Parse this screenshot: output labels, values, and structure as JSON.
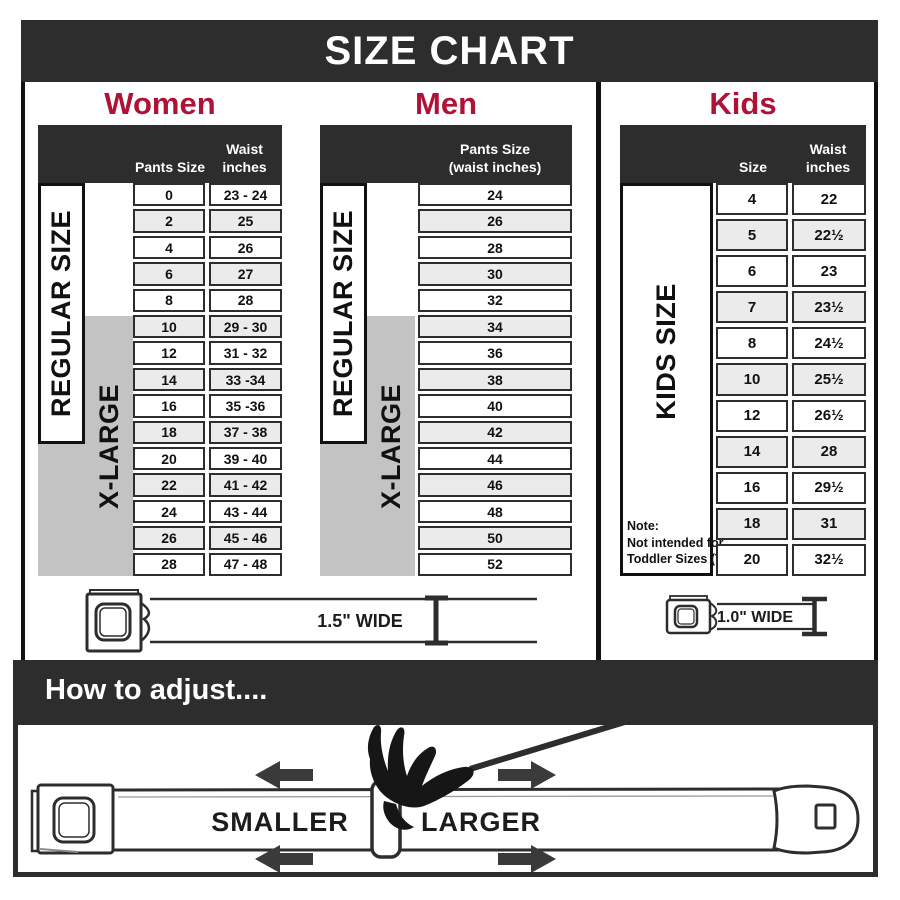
{
  "title": "SIZE CHART",
  "colors": {
    "charcoal": "#2d2d2d",
    "heading_red": "#b01235",
    "row_alt": "#ebebeb",
    "xlarge_gray": "#c3c3c3"
  },
  "sections": {
    "women": {
      "label": "Women",
      "col1_header": "Pants Size",
      "col2_header": "Waist\ninches",
      "regular_label": "REGULAR SIZE",
      "xlarge_label": "X-LARGE",
      "belt_width_label": "1.5\" WIDE",
      "rows": [
        {
          "size": "0",
          "waist": "23 - 24"
        },
        {
          "size": "2",
          "waist": "25"
        },
        {
          "size": "4",
          "waist": "26"
        },
        {
          "size": "6",
          "waist": "27"
        },
        {
          "size": "8",
          "waist": "28"
        },
        {
          "size": "10",
          "waist": "29 - 30"
        },
        {
          "size": "12",
          "waist": "31 - 32"
        },
        {
          "size": "14",
          "waist": "33 -34"
        },
        {
          "size": "16",
          "waist": "35 -36"
        },
        {
          "size": "18",
          "waist": "37 - 38"
        },
        {
          "size": "20",
          "waist": "39 - 40"
        },
        {
          "size": "22",
          "waist": "41 - 42"
        },
        {
          "size": "24",
          "waist": "43 - 44"
        },
        {
          "size": "26",
          "waist": "45 - 46"
        },
        {
          "size": "28",
          "waist": "47 - 48"
        }
      ]
    },
    "men": {
      "label": "Men",
      "col_header": "Pants Size\n(waist inches)",
      "regular_label": "REGULAR SIZE",
      "xlarge_label": "X-LARGE",
      "rows": [
        "24",
        "26",
        "28",
        "30",
        "32",
        "34",
        "36",
        "38",
        "40",
        "42",
        "44",
        "46",
        "48",
        "50",
        "52"
      ]
    },
    "kids": {
      "label": "Kids",
      "col1_header": "Size",
      "col2_header": "Waist\ninches",
      "side_label": "KIDS SIZE",
      "belt_width_label": "1.0\" WIDE",
      "note_lines": [
        "Note:",
        "Not intended for",
        "Toddler Sizes (T)"
      ],
      "rows": [
        {
          "size": "4",
          "waist": "22"
        },
        {
          "size": "5",
          "waist": "22½"
        },
        {
          "size": "6",
          "waist": "23"
        },
        {
          "size": "7",
          "waist": "23½"
        },
        {
          "size": "8",
          "waist": "24½"
        },
        {
          "size": "10",
          "waist": "25½"
        },
        {
          "size": "12",
          "waist": "26½"
        },
        {
          "size": "14",
          "waist": "28"
        },
        {
          "size": "16",
          "waist": "29½"
        },
        {
          "size": "18",
          "waist": "31"
        },
        {
          "size": "20",
          "waist": "32½"
        }
      ]
    }
  },
  "adjust": {
    "heading": "How to adjust....",
    "smaller_label": "SMALLER",
    "larger_label": "LARGER"
  }
}
